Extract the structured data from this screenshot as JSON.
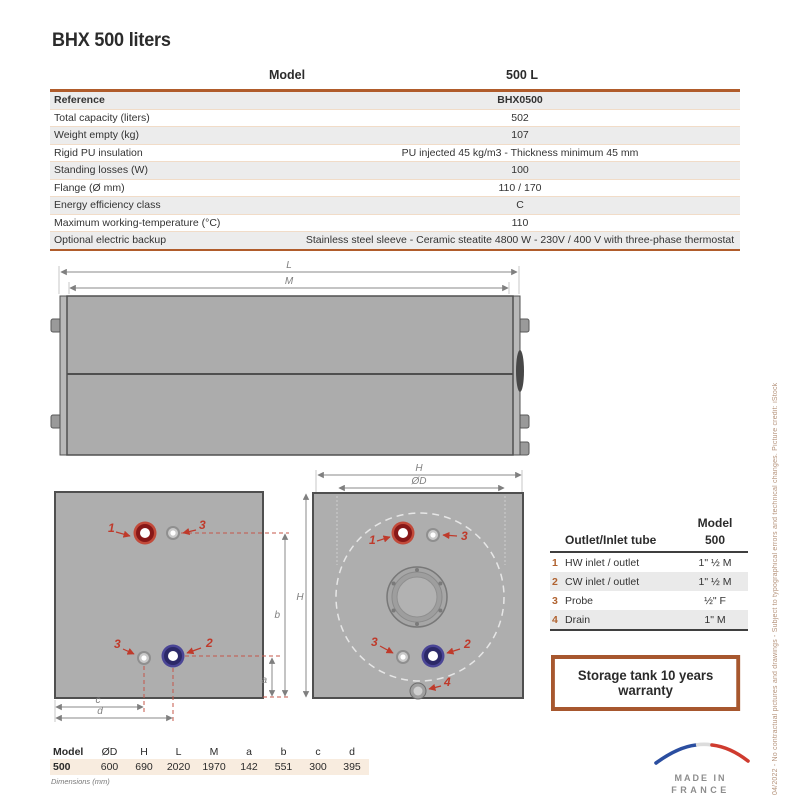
{
  "title": "BHX 500 liters",
  "spec_table": {
    "header": {
      "model": "Model",
      "value": "500 L"
    },
    "rows": [
      {
        "label": "Reference",
        "value": "BHX0500"
      },
      {
        "label": "Total capacity (liters)",
        "value": "502"
      },
      {
        "label": "Weight empty (kg)",
        "value": "107"
      },
      {
        "label": "Rigid PU insulation",
        "value": "PU injected 45 kg/m3 - Thickness minimum 45 mm"
      },
      {
        "label": "Standing losses (W)",
        "value": "100"
      },
      {
        "label": "Flange (Ø mm)",
        "value": "110 / 170"
      },
      {
        "label": "Energy efficiency class",
        "value": "C"
      },
      {
        "label": "Maximum working-temperature  (°C)",
        "value": "110"
      },
      {
        "label": "Optional electric backup",
        "value": "Stainless steel sleeve - Ceramic steatite 4800 W - 230V / 400 V with three-phase thermostat"
      }
    ]
  },
  "diagram": {
    "dims": {
      "L": "L",
      "M": "M",
      "H": "H",
      "OD": "ØD",
      "a": "a",
      "b": "b",
      "c": "c",
      "d": "d"
    },
    "ports": {
      "p1": "1",
      "p2": "2",
      "p3": "3",
      "p4": "4"
    }
  },
  "outlet_table": {
    "model_label": "Model",
    "model_value": "500",
    "title": "Outlet/Inlet tube",
    "rows": [
      {
        "num": "1",
        "label": "HW inlet / outlet",
        "value": "1\" ½ M"
      },
      {
        "num": "2",
        "label": "CW inlet / outlet",
        "value": "1\" ½ M"
      },
      {
        "num": "3",
        "label": "Probe",
        "value": "½\" F"
      },
      {
        "num": "4",
        "label": "Drain",
        "value": "1\" M"
      }
    ]
  },
  "warranty_text": "Storage tank 10 years warranty",
  "dims_table": {
    "headers": [
      "Model",
      "ØD",
      "H",
      "L",
      "M",
      "a",
      "b",
      "c",
      "d"
    ],
    "values": [
      "500",
      "600",
      "690",
      "2020",
      "1970",
      "142",
      "551",
      "300",
      "395"
    ],
    "note": "Dimensions (mm)"
  },
  "made_in": {
    "line1": "MADE IN",
    "line2": "FRANCE"
  },
  "side_note": "04/2022 - No contractual pictures and drawings - Subject to typographical errors and technical changes. Picture credit: iStock",
  "colors": {
    "accent": "#b05c2b",
    "row_shade": "#ececec",
    "peach_row": "#f8ecdf",
    "port_red": "#8e1a1a",
    "port_blue": "#2c2968",
    "label_red": "#bf3a2b",
    "warranty_border": "#a7572e",
    "tank_gray": "#acacac",
    "flag_blue": "#2b4ea0",
    "flag_red": "#cf3b2f"
  }
}
